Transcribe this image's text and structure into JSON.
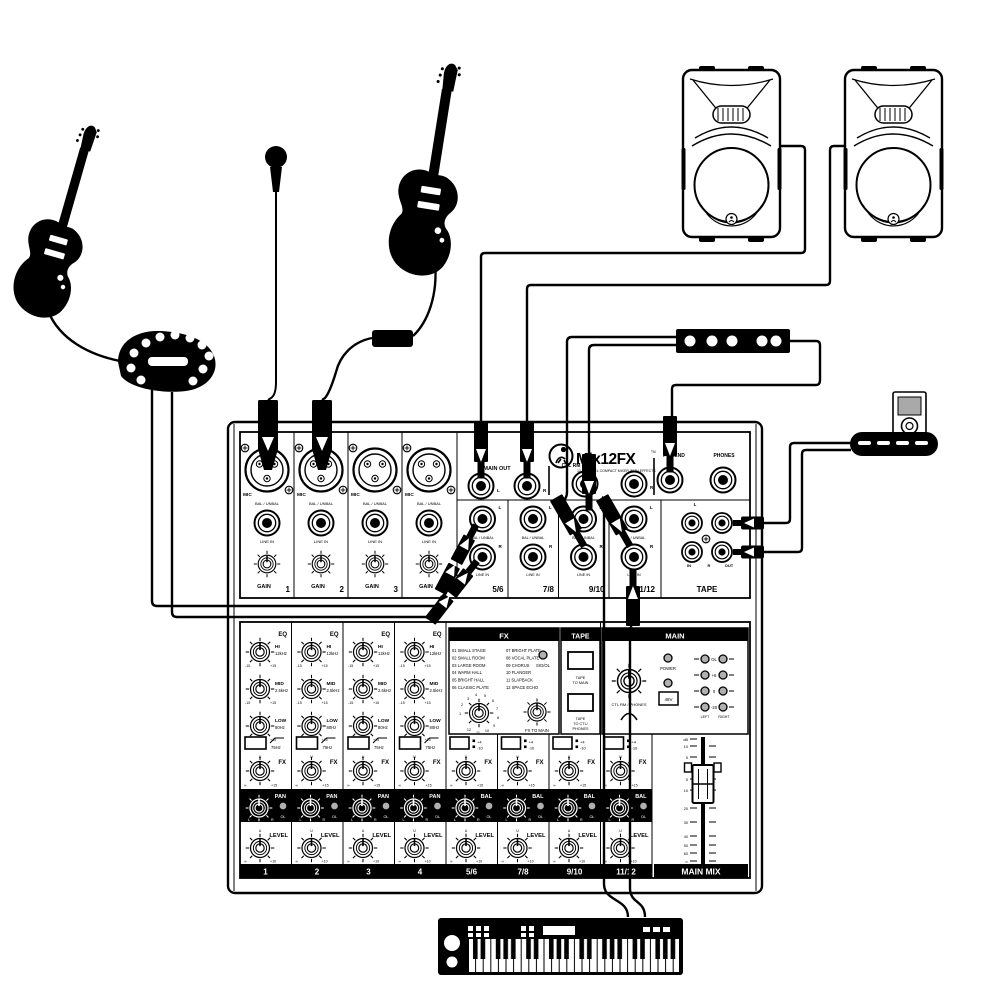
{
  "logo": {
    "name": "Mix12FX",
    "tm": "TM",
    "subtitle": "12-CHANNEL COMPACT MIXER WITH EFFECTS",
    "brand_icon": "mackie-running-man-icon"
  },
  "top": {
    "mic": "MIC",
    "bal_unbal": "BAL / UNBAL",
    "line_in": "LINE IN",
    "gain": "GAIN",
    "mono_nums": [
      "1",
      "2",
      "3",
      "4"
    ],
    "main_out": "MAIN OUT",
    "ctl_rm_out": "CTL RM OUT",
    "l": "L",
    "r": "R",
    "fx_send": "FX SEND",
    "phones": "PHONES",
    "stereo_nums": [
      "5/6",
      "7/8",
      "9/10",
      "11/12"
    ],
    "tape": "TAPE",
    "tape_in": "IN",
    "tape_out": "OUT"
  },
  "lower": {
    "eq": "EQ",
    "hi": "HI",
    "hi_f": "12kHz",
    "mid": "MID",
    "mid_f": "2.5kHz",
    "low": "LOW",
    "low_f": "80Hz",
    "m15": "-15",
    "p15": "+15",
    "low_cut": "75Hz",
    "fx": "FX",
    "u": "U",
    "inf": "∞",
    "pan": "PAN",
    "bal": "BAL",
    "ol": "OL",
    "l": "L",
    "r": "R",
    "level": "LEVEL",
    "p10": "+10",
    "p4": "+4",
    "m10": "-10",
    "strip_nums": [
      "1",
      "2",
      "3",
      "4",
      "5/6",
      "7/8",
      "9/10",
      "11/12"
    ]
  },
  "fx_section": {
    "header": "FX",
    "effects": [
      "01 SMALL STAGE",
      "02 SMALL ROOM",
      "03 LARGE ROOM",
      "04 WARM HALL",
      "05 BRIGHT HALL",
      "06 CLASSIC PLATE",
      "07 BRIGHT PLATE",
      "08 VOCAL PLATE",
      "09 CHORUS",
      "10 FLANGER",
      "11 SLAPBACK",
      "12 SPACE ECHO"
    ],
    "sig_ol": "SIG/OL",
    "selector_numbers": [
      "1",
      "2",
      "3",
      "4",
      "5",
      "6",
      "7",
      "8",
      "9",
      "10",
      "11",
      "12"
    ],
    "fx_to_main": "FX TO MAIN"
  },
  "tape_section": {
    "header": "TAPE",
    "to_main_lines": [
      "TAPE",
      "TO MAIN"
    ],
    "to_phones_lines": [
      "TAPE",
      "TO CTL/",
      "PHONES"
    ]
  },
  "main_section": {
    "header": "MAIN",
    "power": "POWER",
    "phantom": "48V",
    "ctl_phones": "CTL RM / PHONES",
    "meter_labels": [
      "OL",
      "+6",
      "0",
      "-20"
    ],
    "left": "LEFT",
    "right": "RIGHT",
    "fader_scale": [
      "dB",
      "10",
      "5",
      "U",
      "5",
      "10",
      "20",
      "30",
      "40",
      "50",
      "60",
      "∞"
    ],
    "main_mix": "MAIN MIX"
  },
  "devices": {
    "left_guitar": "electric-guitar-icon",
    "right_guitar": "electric-guitar-icon",
    "microphone": "microphone-icon",
    "fx_pedal": "multi-effects-pedal-icon",
    "speaker_left": "powered-speaker-icon",
    "speaker_right": "powered-speaker-icon",
    "fx_unit": "effects-processor-icon",
    "mp3_player": "mp3-player-icon",
    "dock": "player-dock-icon",
    "keyboard": "synth-keyboard-icon"
  },
  "colors": {
    "ink": "#000000",
    "panel": "#ffffff",
    "led": "#b0b0b0",
    "screen": "#a9a9a9"
  }
}
